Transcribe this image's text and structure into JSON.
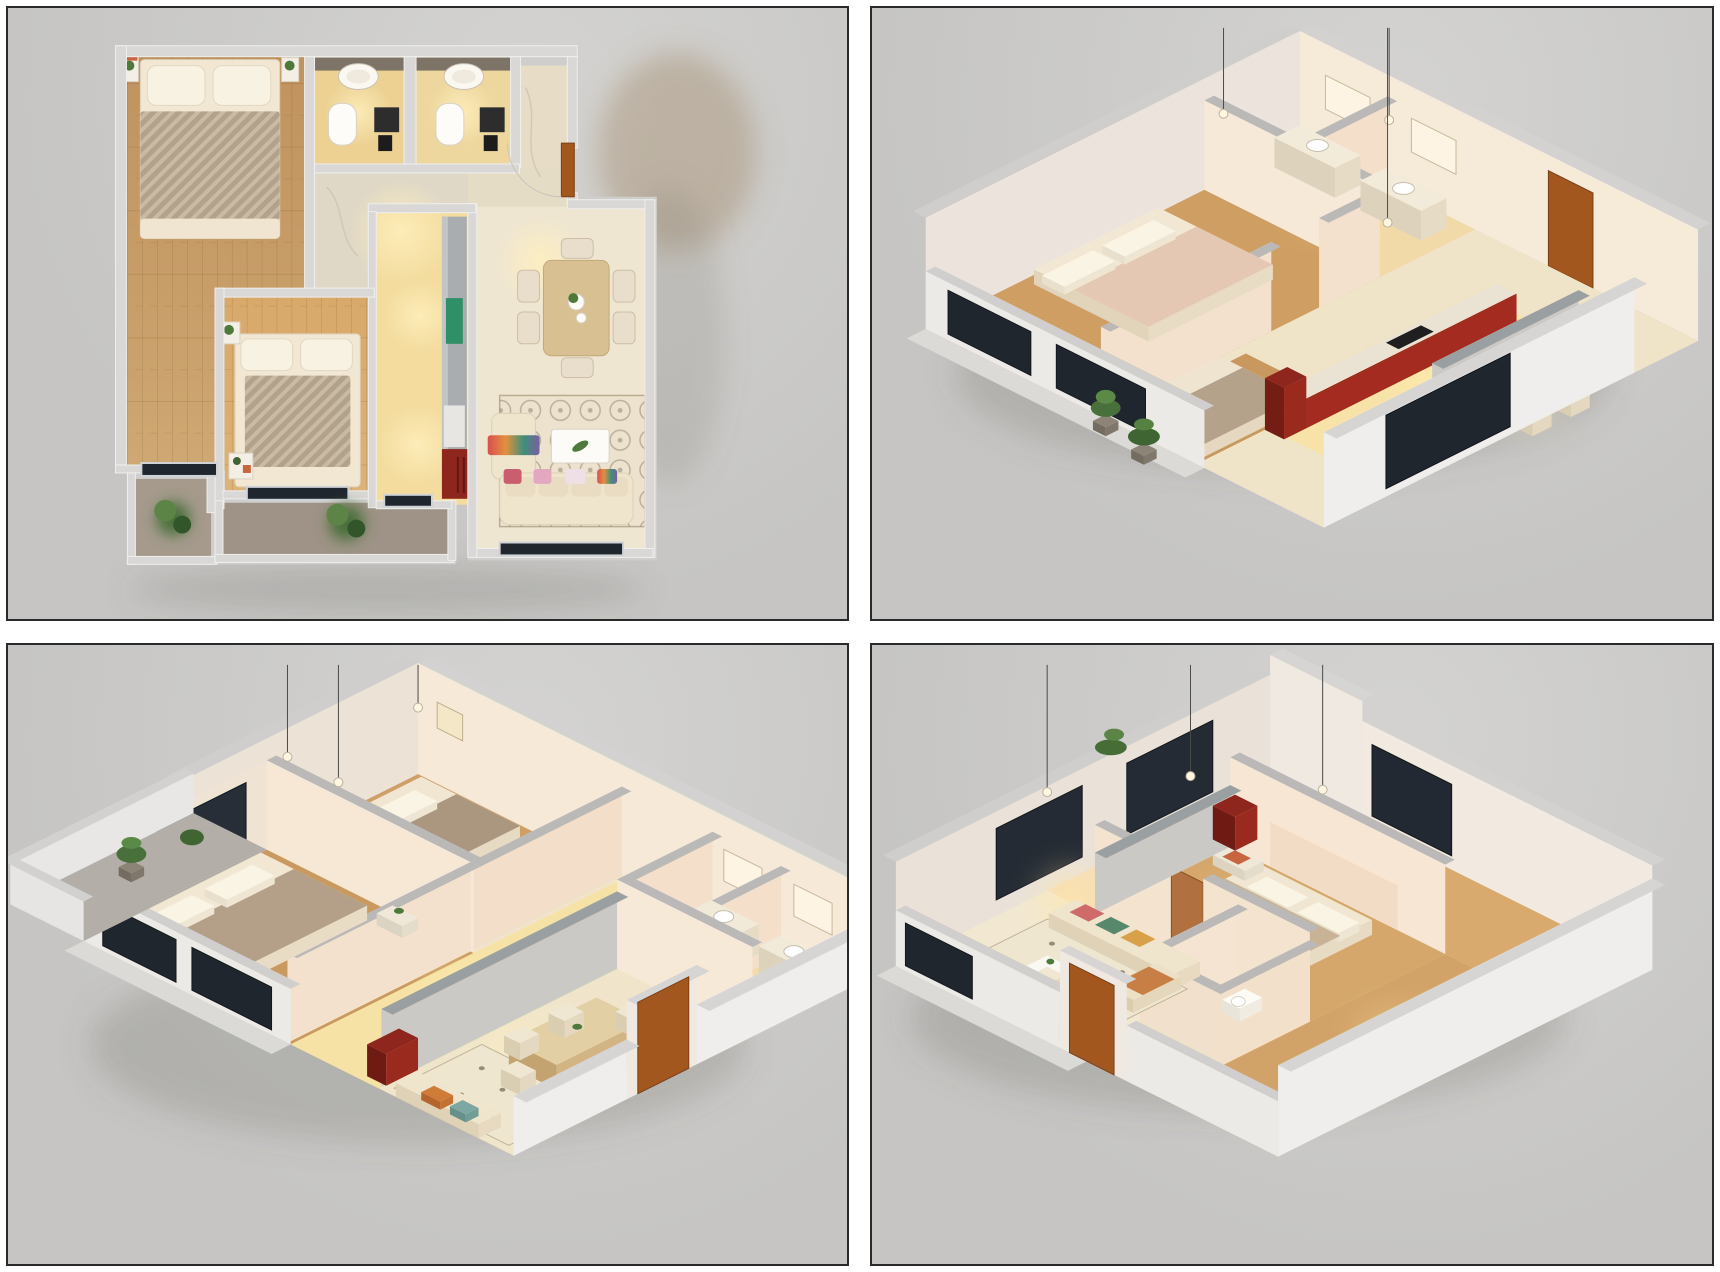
{
  "page": {
    "title": "apartment-3d-floor-plan-renders",
    "layout": "2x2-grid"
  },
  "colors": {
    "page-bg": "#ffffff",
    "panel-bg": "#c6c5c3",
    "panel-bg-light": "#d4d3d1",
    "panel-border": "#2a2a2a",
    "wall-2d": "#d9d8d6",
    "wall-top": "#b7b6b4",
    "wall-outer": "#efeeec",
    "floor-wood": "#c89a62",
    "floor-wood-light": "#d8aa6e",
    "floor-marble": "#e0d8c6",
    "floor-marble-warm": "#f0e4c8",
    "floor-glow": "#f7e3a8",
    "balcony-floor": "#a59a8c",
    "terrace-floor": "#9e9386",
    "kitchen-red": "#8e261d",
    "counter-gray": "#9aa0a2",
    "counter-face": "#cbc9c6",
    "cutting-green": "#2f8f66",
    "bed-sheet": "#f2e7d2",
    "duvet": "#b4a089",
    "pillow": "#f8f2e3",
    "sofa": "#efe4cc",
    "rug": "#ece2cd",
    "rug-motif": "#8f8672",
    "table-wood": "#d8c093",
    "chair": "#e9decb",
    "door-brown": "#a2571f",
    "window-glass": "#20262e",
    "plant-green": "#4d7a3a"
  },
  "panels": [
    {
      "name": "floor-plan-top-down",
      "view": "top-down render",
      "position": "top-left"
    },
    {
      "name": "floor-plan-isometric-front",
      "view": "isometric render",
      "position": "top-right"
    },
    {
      "name": "floor-plan-isometric-left",
      "view": "isometric render",
      "position": "bottom-left"
    },
    {
      "name": "floor-plan-isometric-right",
      "view": "isometric render",
      "position": "bottom-right"
    }
  ]
}
